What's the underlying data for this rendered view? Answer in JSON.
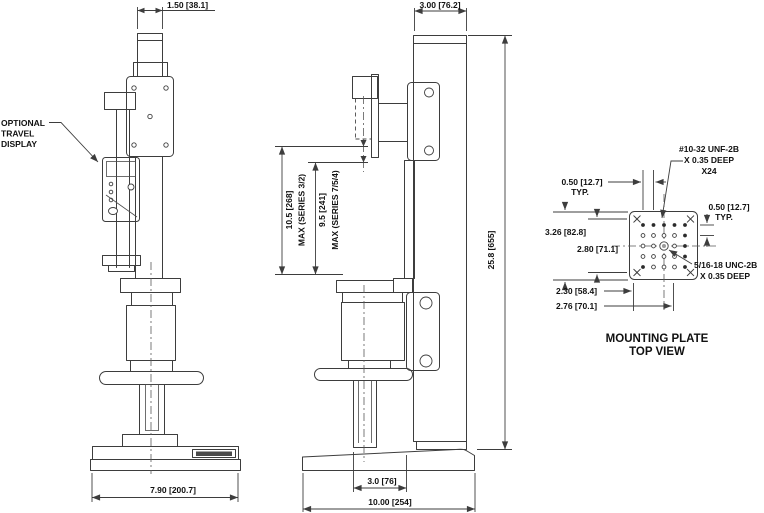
{
  "colors": {
    "line": "#3d3d3d",
    "text": "#111111",
    "background": "#ffffff",
    "dark_fill": "#4a4a4a"
  },
  "front_view": {
    "callout_display_line1": "OPTIONAL",
    "callout_display_line2": "TRAVEL",
    "callout_display_line3": "DISPLAY",
    "dim_top_width": "1.50 [38.1]",
    "dim_base_width": "7.90 [200.7]"
  },
  "side_view": {
    "dim_column_width": "3.00 [76.2]",
    "dim_overall_height": "25.8 [655]",
    "dim_travel_a": "10.5 [268]",
    "dim_travel_a_note": "MAX (SERIES 3/2)",
    "dim_travel_b": "9.5 [241]",
    "dim_travel_b_note": "MAX (SERIES 7/5/4)",
    "dim_throat": "3.0 [76]",
    "dim_base_depth": "10.00 [254]"
  },
  "mounting_plate": {
    "caption_line1": "MOUNTING PLATE",
    "caption_line2": "TOP VIEW",
    "callout_small_holes_line1": "#10-32 UNF-2B",
    "callout_small_holes_line2": "X 0.35 DEEP",
    "callout_small_holes_line3": "X24",
    "callout_center_hole_line1": "5/16-18 UNC-2B",
    "callout_center_hole_line2": "X 0.35 DEEP",
    "dim_pitch_top": "0.50 [12.7]",
    "dim_pitch_top_note": "TYP.",
    "dim_pitch_right": "0.50 [12.7]",
    "dim_pitch_right_note": "TYP.",
    "dim_plate_size": "3.26 [82.8]",
    "dim_hole_span": "2.80 [71.1]",
    "dim_bottom_a": "2.30 [58.4]",
    "dim_bottom_b": "2.76 [70.1]"
  }
}
